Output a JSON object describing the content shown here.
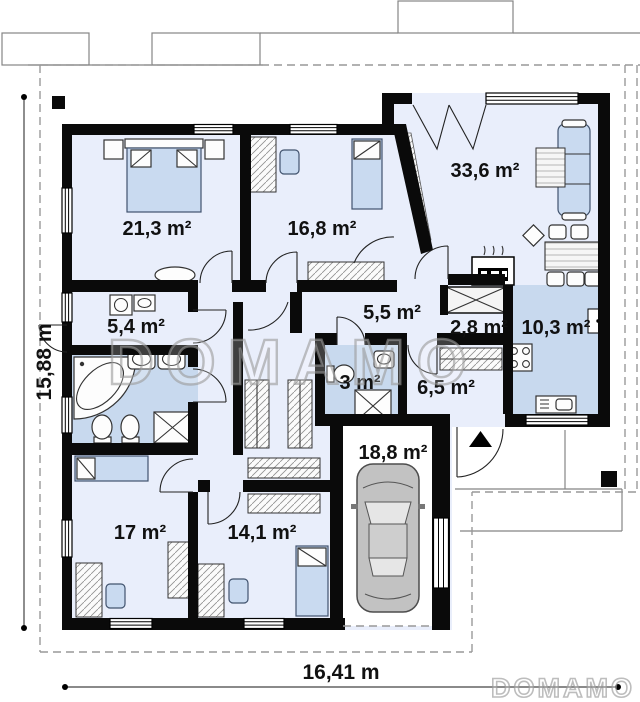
{
  "plan": {
    "type": "floor-plan",
    "watermark_center": "DOMAMO",
    "watermark_corner": "DOMAMO",
    "dimension_height": {
      "label": "15,88 m"
    },
    "dimension_width": {
      "label": "16,41 m"
    },
    "rooms": [
      {
        "name": "bedroom-master",
        "label": "21,3 m²"
      },
      {
        "name": "bedroom-2",
        "label": "16,8 m²"
      },
      {
        "name": "living-room",
        "label": "33,6 m²"
      },
      {
        "name": "laundry",
        "label": "5,4 m²"
      },
      {
        "name": "hall",
        "label": "5,5 m²"
      },
      {
        "name": "pantry",
        "label": "2,8 m²"
      },
      {
        "name": "kitchen",
        "label": "10,3 m²"
      },
      {
        "name": "wc",
        "label": "3 m²"
      },
      {
        "name": "corridor",
        "label": "6,5 m²"
      },
      {
        "name": "garage",
        "label": "18,8 m²"
      },
      {
        "name": "bedroom-3",
        "label": "17 m²"
      },
      {
        "name": "bedroom-4",
        "label": "14,1 m²"
      }
    ],
    "colors": {
      "wall": "#0a0a0a",
      "floor": "#e9eefb",
      "wet_room": "#c8d9ee",
      "furniture_accent": "#c9daf0"
    }
  }
}
